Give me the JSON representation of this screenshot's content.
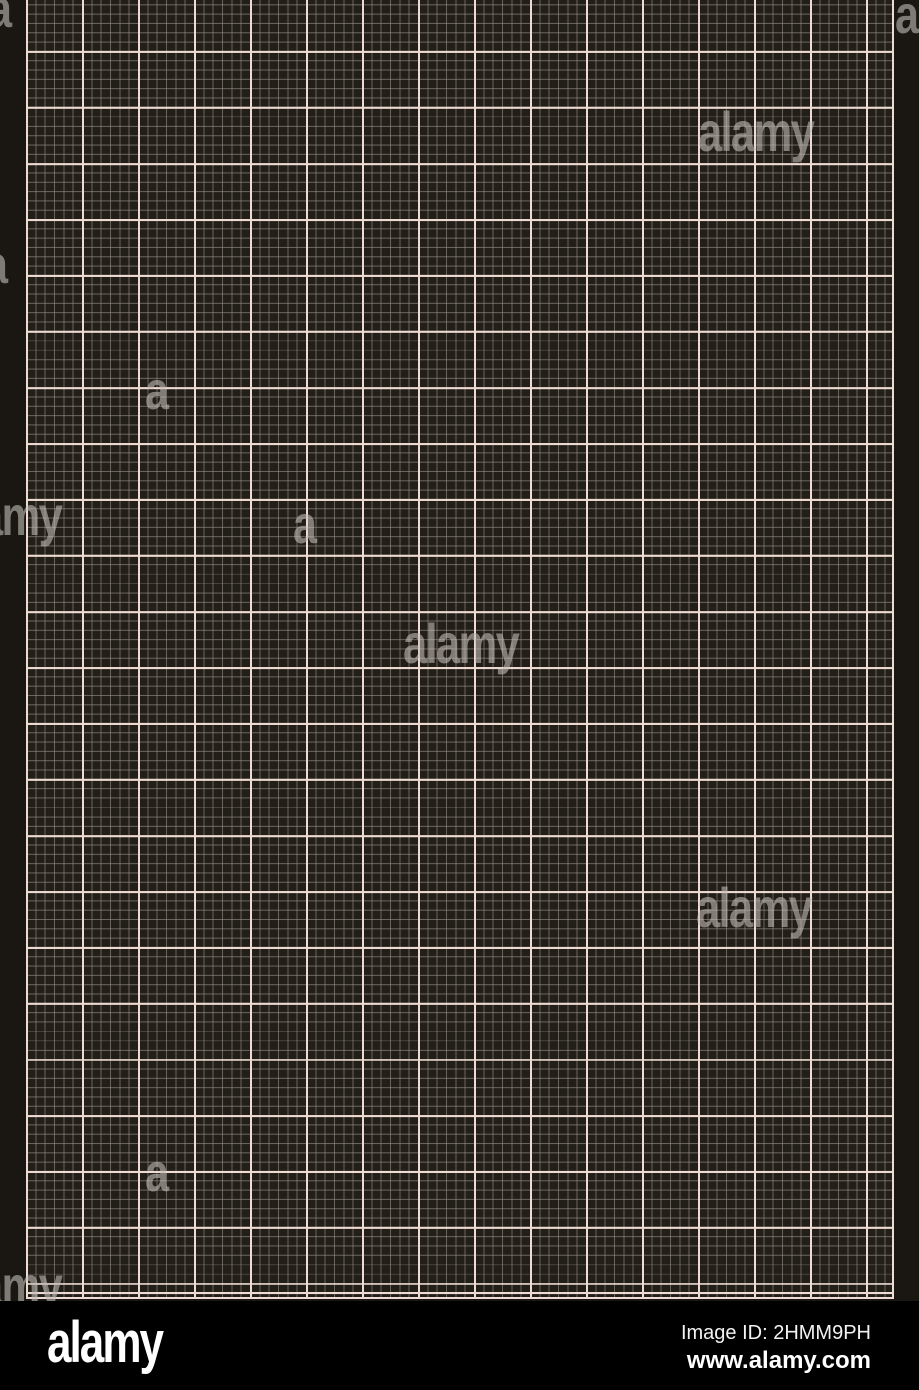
{
  "image": {
    "width_px": 919,
    "height_px": 1390,
    "description": "Black graph paper / millimeter grid pattern stock image with Alamy watermarks"
  },
  "graph_paper": {
    "margin_color": "#1a1712",
    "paper_color": "#221e18",
    "minor_line_color": "rgba(154,146,138,0.6)",
    "major_line_color": "#eedcd4",
    "minor_cell_px": 9.33,
    "major_cell_px": 56,
    "paper_left_px": 26,
    "paper_width_px": 868,
    "paper_height_px": 1299
  },
  "watermark": {
    "word": "alamy",
    "letter": "a",
    "color": "rgba(193,188,182,0.6)",
    "instances": [
      {
        "kind": "letter",
        "x": -12,
        "y": -18
      },
      {
        "kind": "letter",
        "x": 895,
        "y": -12
      },
      {
        "kind": "word",
        "x": 698,
        "y": 104
      },
      {
        "kind": "letter",
        "x": -16,
        "y": 238
      },
      {
        "kind": "letter",
        "x": 145,
        "y": 364
      },
      {
        "kind": "word",
        "x": -54,
        "y": 488
      },
      {
        "kind": "letter",
        "x": 293,
        "y": 498
      },
      {
        "kind": "word",
        "x": 403,
        "y": 616
      },
      {
        "kind": "word",
        "x": 696,
        "y": 880
      },
      {
        "kind": "letter",
        "x": 145,
        "y": 1146
      },
      {
        "kind": "word",
        "x": -54,
        "y": 1258
      }
    ]
  },
  "stock_footer": {
    "brand_logo": "alamy",
    "image_id": "Image ID: 2HMM9PH",
    "website": "www.alamy.com",
    "bar_color": "#000000",
    "text_color": "#ffffff"
  }
}
